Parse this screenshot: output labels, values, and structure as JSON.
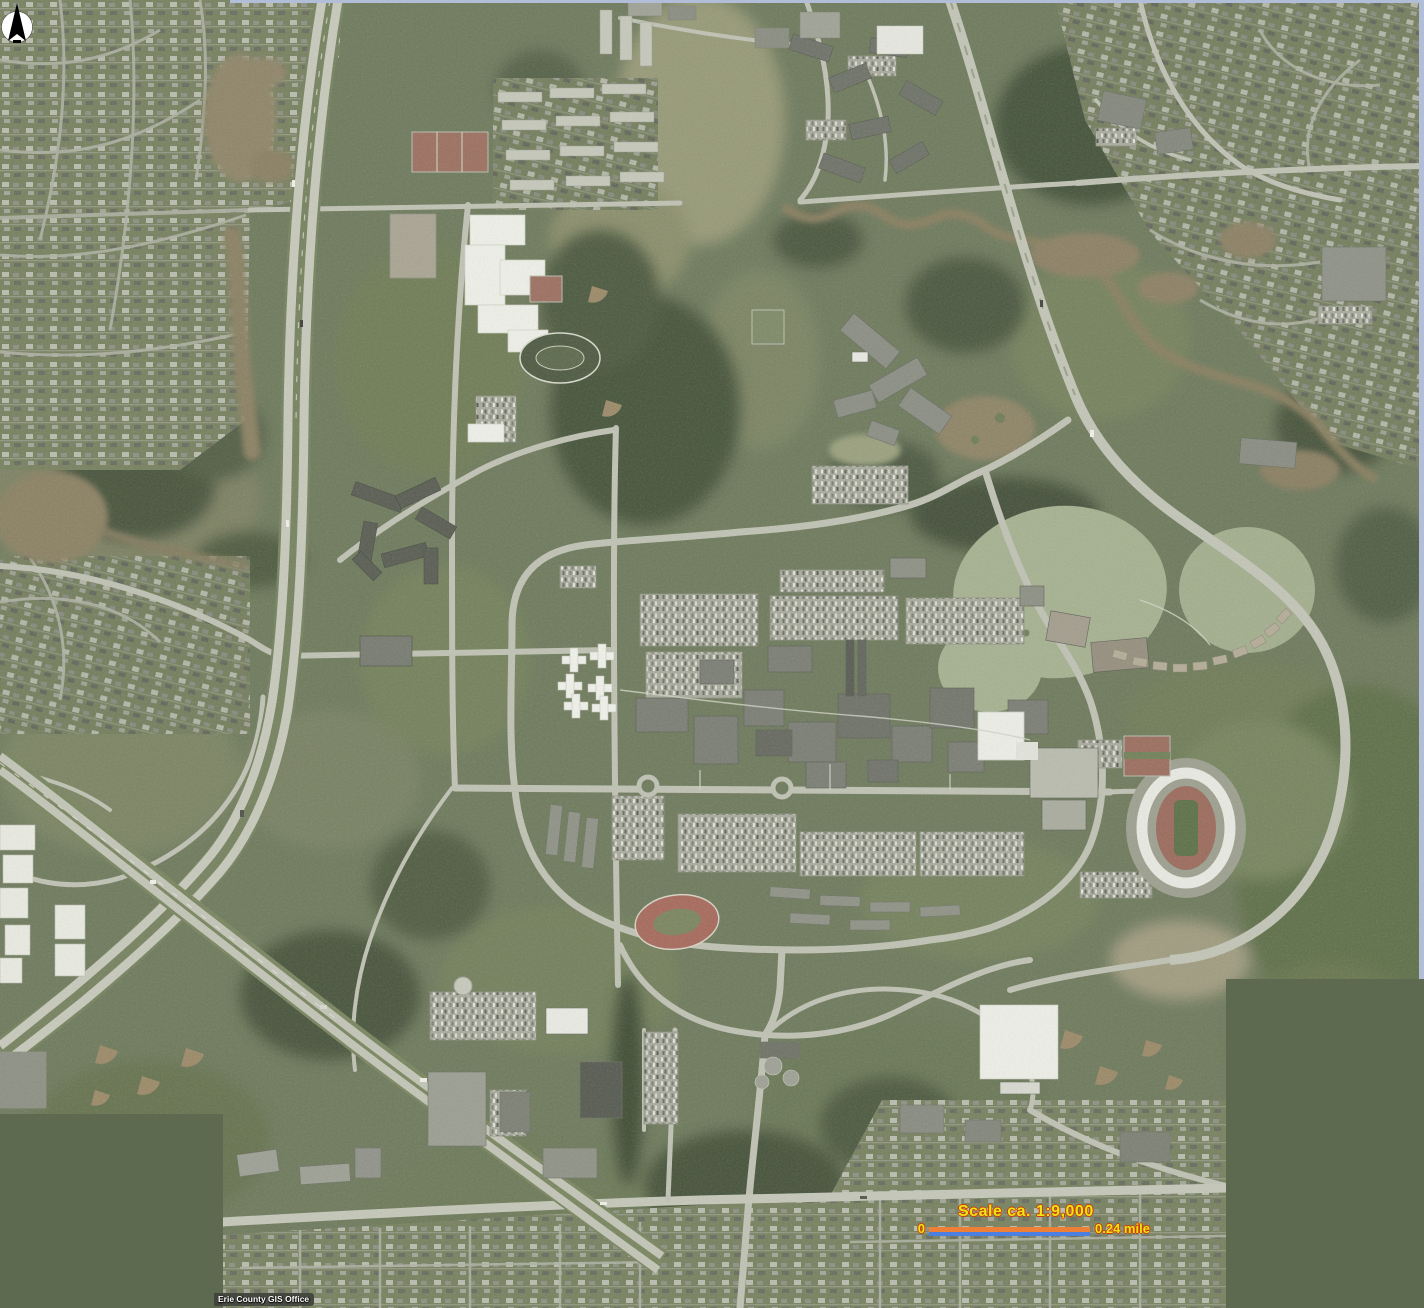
{
  "overlay": {
    "scale_title": "Scale ca. 1:9,000",
    "scale_bar": {
      "left_label": "0",
      "right_label": "0.24 mile",
      "top_color": "#ee7f36",
      "bottom_color": "#4b80e2"
    },
    "north_arrow": {
      "icon": "compass-north-arrow",
      "circle_color": "#ffffff",
      "needle_color": "#000000"
    },
    "attribution": {
      "text": "Erie County GIS Office",
      "text_color": "#ffffff",
      "bg_color": "rgba(62,64,58,0.88)"
    },
    "label_color": "#ece714",
    "label_outline_color": "#cf3a05"
  },
  "palette": {
    "grass_base": "#6e7a5c",
    "field_light": "#87926e",
    "scrub": "#a3a98a",
    "woods_dark": "#47543b",
    "road": "#bfc2b3",
    "highway": "#c6c9ba",
    "building_gray": "#7b7e74",
    "building_dark": "#565a50",
    "building_white": "#eef0e8",
    "parking": "#a8ab9c",
    "lake_water": "#a6b190",
    "pond_brown": "#8f8468",
    "track_red": "#a66a5b",
    "mosaic_fill": "#5d6a4f",
    "mosaic_edge": "#b2bdd8"
  }
}
